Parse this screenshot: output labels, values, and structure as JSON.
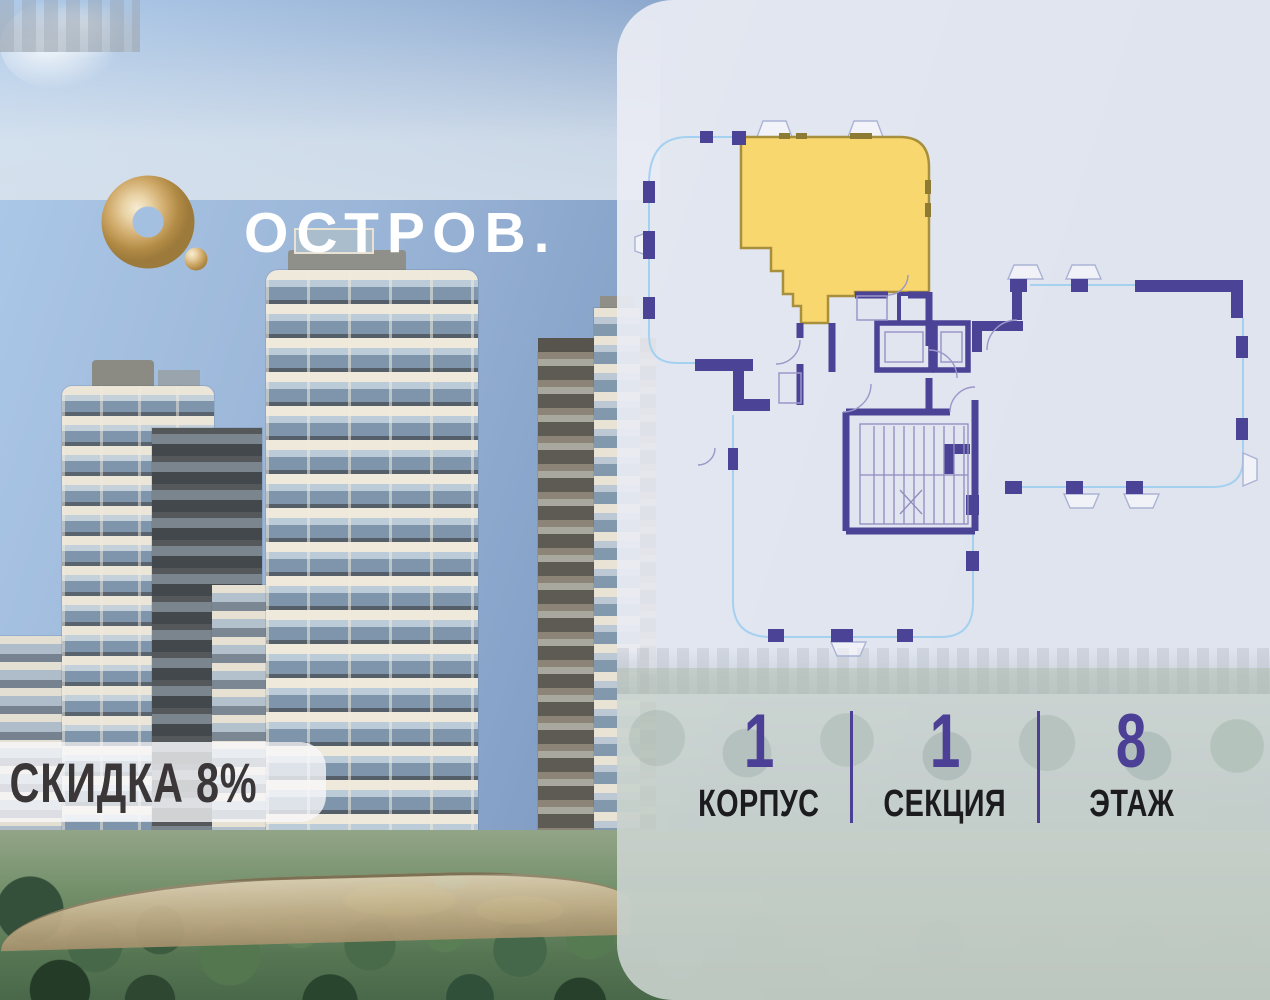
{
  "logo": {
    "text": "ОСТРОВ.",
    "mark_icon": "gold-torus-with-dot"
  },
  "badge": {
    "text": "СКИДКА 8%"
  },
  "stats": {
    "items": [
      {
        "value": "1",
        "label": "КОРПУС"
      },
      {
        "value": "1",
        "label": "СЕКЦИЯ"
      },
      {
        "value": "8",
        "label": "ЭТАЖ"
      }
    ]
  },
  "floor_plan": {
    "highlighted_apartment": "corner apartment, top-left of floor plate",
    "highlight_fill": "#f8d76e",
    "highlight_border": "#a6903d",
    "wall_color": "#4b4396",
    "facade_outline_color": "#a5d1f1"
  },
  "colors": {
    "accent_purple": "#4c3f96",
    "panel_background": "#e9ecf3",
    "label_dark": "#1c1c1e"
  }
}
